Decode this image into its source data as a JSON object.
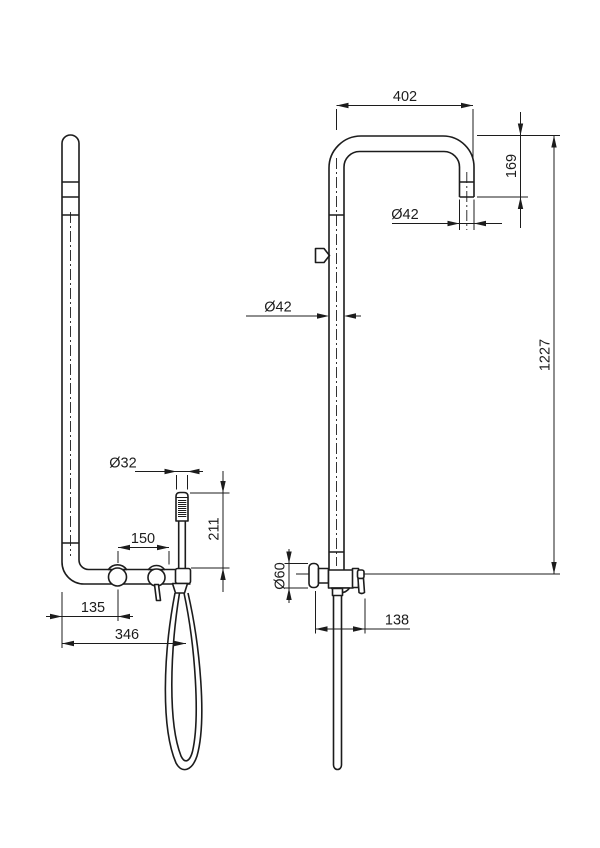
{
  "drawing": {
    "background": "#ffffff",
    "line_color": "#1c1c1c",
    "dimensions": {
      "arm_reach": {
        "label": "402",
        "value": 402,
        "orientation": "horizontal"
      },
      "arm_drop": {
        "label": "169",
        "value": 169,
        "orientation": "vertical"
      },
      "outlet_diameter": {
        "label": "Ø42",
        "value": 42,
        "orientation": "horizontal"
      },
      "riser_diameter": {
        "label": "Ø42",
        "value": 42,
        "orientation": "horizontal"
      },
      "total_height": {
        "label": "1227",
        "value": 1227,
        "orientation": "vertical"
      },
      "handshower_diameter": {
        "label": "Ø32",
        "value": 32,
        "orientation": "horizontal"
      },
      "handshower_length": {
        "label": "211",
        "value": 211,
        "orientation": "vertical"
      },
      "valve_spacing": {
        "label": "150",
        "value": 150,
        "orientation": "horizontal"
      },
      "wall_to_first_valve": {
        "label": "135",
        "value": 135,
        "orientation": "horizontal"
      },
      "wall_to_hose": {
        "label": "346",
        "value": 346,
        "orientation": "horizontal"
      },
      "valve_body_diameter": {
        "label": "Ø60",
        "value": 60,
        "orientation": "vertical"
      },
      "wall_to_lever": {
        "label": "138",
        "value": 138,
        "orientation": "horizontal"
      }
    }
  }
}
